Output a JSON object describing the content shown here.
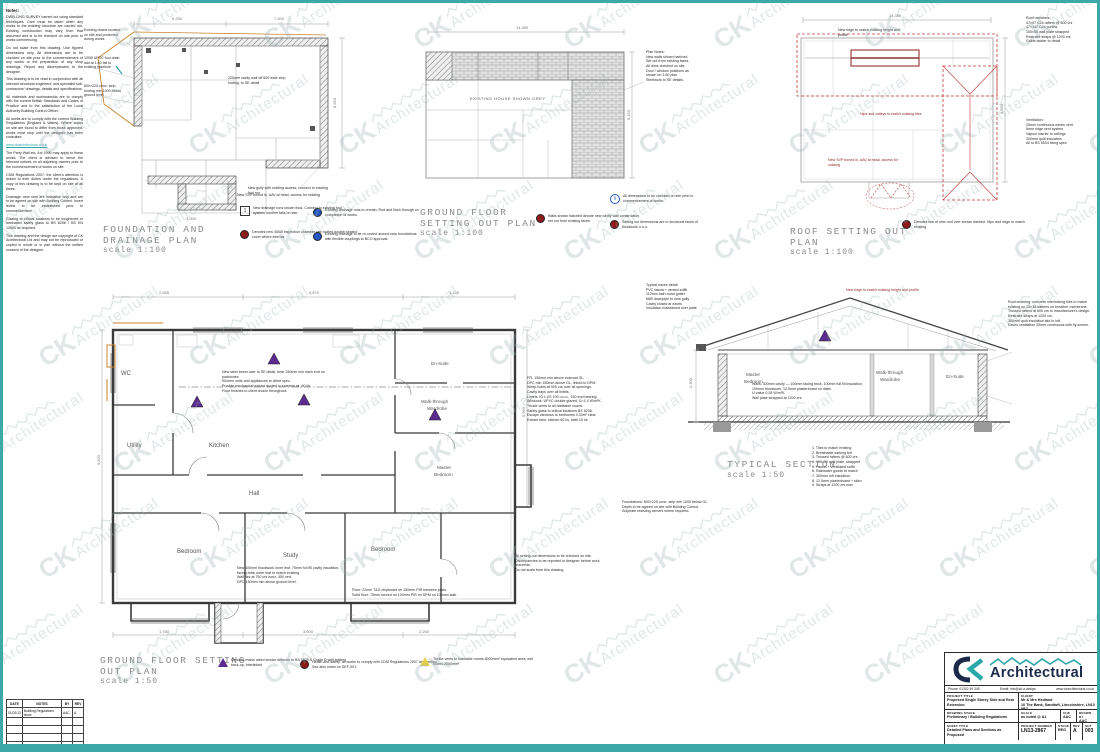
{
  "sheet": {
    "border_color": "#3DA8A8",
    "watermark": {
      "ck": "CK",
      "word": "Architectural"
    }
  },
  "notes_left": {
    "heading": "Notes:",
    "p1": "DWELLING SURVEY carried out using standard techniques. Care must be taken when any works to the existing structure are carried out. Existing construction may vary from that assumed and is to be checked on site prior to works commencing.",
    "p2": "Do not scale from this drawing. Use figured dimensions only. All dimensions are to be checked on site prior to the commencement of any works or the preparation of any shop drawings. Report any discrepancies to the designer.",
    "p3": "This drawing is to be read in conjunction with all relevant structural engineers' and specialist sub-contractors' drawings, details and specifications.",
    "p4": "All materials and workmanship are to comply with the current British Standards and Codes of Practice and to the satisfaction of the Local Authority Building Control Officer.",
    "p5": "All works are to comply with the current Building Regulations (England & Wales). Where works on site are found to differ from those approved, works must stop until the designer has been consulted.",
    "p6": "The Party Wall etc. Act 1996 may apply to these works. The client is advised to serve the relevant notices on all adjoining owners prior to the commencement of works on site.",
    "p7": "CDM Regulations 2007: the client's attention is drawn to their duties under the regulations. A copy of this drawing is to be kept on site at all times.",
    "p8": "Drainage: new runs are indicative only and are to be agreed on site with Building Control. Invert levels to be established prior to commencement.",
    "p9": "Glazing to critical locations to be toughened or laminated safety glass to BS 6206 / BS EN 12600 as required.",
    "p10": "This drawing and the design are copyright of CK Architectural Ltd and may not be reproduced or copied in whole or in part without the written consent of the designer.",
    "link": "www.ckarchitectural.co.uk"
  },
  "revision_table": {
    "headers": [
      "DATE",
      "NOTES",
      "BY",
      "REV"
    ],
    "rows": [
      [
        "01/02/13",
        "Building Regulations issue",
        "AAC",
        "A"
      ]
    ]
  },
  "plans": {
    "foundation": {
      "title": "FOUNDATION AND\nDRAINAGE PLAN",
      "scale": "scale 1:100",
      "dims": {
        "top1": "6,250",
        "top2": "7,400",
        "right": "8,550",
        "porch": "3,000"
      }
    },
    "gf100": {
      "title": "GROUND FLOOR\nSETTING OUT PLAN",
      "scale": "scale 1:100",
      "center_label": "EXISTING HOUSE SHOWN GREY",
      "dims": {
        "top": "14,350",
        "right": "9,150"
      },
      "notes": "Plan Notes:\nNew walls shown hatched.\nSet out from existing faces.\nAll dims checked on site.\nDoor / window positions as\nshown on 1:50 plan.\nSteelwork to SE details."
    },
    "roof": {
      "title": "ROOF SETTING OUT\nPLAN",
      "scale": "scale 1:100",
      "dims": {
        "top": "14,350",
        "right": "9,560"
      },
      "notes1": "Roof members:\n47×97 C24 rafters @ 600 crs\n47×147 C24 purlins\n100×50 wall plate strapped\nRestraint straps @ 1200 crs\nGable ladder to detail",
      "notes2": "Ventilation:\n25mm continuous eaves vent\n5mm ridge vent system\nVapour barrier to ceilings\n300mm quilt insulation\nAll to BS 5534 fixing spec"
    },
    "gf50": {
      "title": "GROUND FLOOR SETTING\nOUT PLAN",
      "scale": "scale 1:50",
      "dims": {
        "top1": "2,655",
        "top2": "4,870",
        "top3": "3,120",
        "left": "9,820",
        "right": "5,960",
        "bottom1": "1,780",
        "bottom2": "3,600",
        "bottom3": "2,250"
      },
      "rooms": {
        "wc": "WC",
        "utility": "Utility",
        "kitchen": "Kitchen",
        "ensuite": "En-Suite",
        "wardrobe1": "Walk-through",
        "wardrobe2": "Wardrobe",
        "master1": "Master",
        "master2": "Bedroom",
        "hall": "Hall",
        "bedroom1": "Bedroom",
        "study": "Study",
        "bedroom2": "Bedroom"
      }
    },
    "section": {
      "title": "TYPICAL SECTION",
      "scale": "scale 1:50",
      "dims": {
        "left": "2,400"
      },
      "rooms": {
        "master1": "Master",
        "master2": "Bedroom",
        "wardrobe1": "Walk-through",
        "wardrobe2": "Wardrobe",
        "ensuite": "En-Suite"
      },
      "notes": "1.  Tiles to match existing\n2.  Breathable sarking felt\n3.  Trussed rafters @ 600 crs\n4.  100×50 wall plate, strapped\n5.  Fascia + ventilated soffit\n6.  Rainwater goods to match\n7.  300mm loft insulation\n8.  12.5mm plasterboard + skim\n9.  Straps at 1200 crs max"
    }
  },
  "legends": {
    "box1": "New drainage runs shown thus. Connect to existing foul system; confirm falls on site.",
    "red_foundation": "Denotes new 450Ø inspection chamber with bolted double-sealed cover where internal.",
    "blue1": "Existing drainage runs to remain. Rod and flush through on completion of works.",
    "blue2": "Existing drainage to be re-routed around new foundations with flexible couplings to BCO approval.",
    "red_gf100": "Walls shown hatched denote new cavity wall construction set out from existing faces.",
    "info": "All dimensions to be checked on site prior to commencement of works.",
    "red_gf100b": "Setting out dimensions are to structural faces of blockwork u.n.o.",
    "red_roof": "Denotes line of new roof over shown dashed. Hips and ridge to match existing.",
    "purple": "Denotes mains wired smoke detector to BS 5839-6 Grade D with battery back-up, interlinked.",
    "red_gf50": "Health and safety: all works to comply with CDM Regulations 2007 as directed. See also notes on DEF-001.",
    "yellow": "Trickle vents to habitable rooms 8000mm² equivalent area; wet rooms 2500mm²."
  },
  "micro": {
    "a": "100Ø UPVC foul drain laid at 1:40 fall to existing manhole",
    "b": "600×225 conc. strip footing min 1000 below ground level",
    "c": "Existing drains located on site and protected during works",
    "d": "225mm cavity wall off 600 wide strip footing, to SE detail",
    "e": "New SVP boxed in, AAV at head, access for rodding",
    "f": "New gully with rodding access; connect to existing foul run",
    "g": "New ridge to match existing height and profile",
    "h": "Hips and valleys to match existing tiles"
  },
  "ann": {
    "gf50_right": "FFL 150mm min above external GL.\nDPC min 150mm above GL, linked to DPM.\nWeep holes at 900 crs over all openings.\nCavity trays over all lintels.\nLintels: IG L1/S 100 u.n.o., 150 end bearing.\nWindows: UPVC double glazed, U=1.4 W/m²K.\nTrickle vents to all habitable rooms.\nSafety glass to critical locations BS 6206.\nEscape windows to bedrooms 0.33m² clear.\nExtract fans: kitchen 60 l/s, bath 15 l/s.",
    "gf50_bottom1": "New 100mm blockwork inner leaf, 75mm full fill cavity insulation, facing brick outer leaf to match existing.\nWall ties at 750 crs horiz, 450 vert.\nDPC 150mm min above ground level.",
    "gf50_bottom2": "Floor: 22mm T&G chipboard on 150mm PIR between joists.\nSolid floor: 75mm screed on 100mm PIR on DPM on 100mm slab.",
    "gf50_bottom3": "All setting out dimensions to be checked on site.\nDiscrepancies to be reported to designer before work proceeds.\nDo not scale from this drawing.",
    "gf50_center": "New steel beam over to SE detail, bear 150mm min each end on padstones.\nKitchen units and appliances to client spec.\nProvide mechanical extract ducted to external air, 60 l/s.\nFloor finishes to client choice throughout.",
    "section_center": "Walls: 300mm cavity — 100mm facing brick, 100mm full fill insulation, 100mm blockwork, 12.5mm plasterboard on dabs.\nU-value 0.28 W/m²K.\nWall plate strapped at 1200 crs.",
    "section_right": "Roof covering: concrete interlocking tiles to match existing on 25×38 battens on breather membrane.\nTrussed rafters at 600 crs to manufacturer's design.\nRestraint straps at 1200 crs.\n300mm quilt insulation laid in loft.\nEaves ventilation 25mm continuous with fly screen.",
    "section_below": "Foundations: 600×225 conc. strip min 1000 below GL.\nDepth to be agreed on site with Building Control.\nSulphate resisting cement where required.",
    "buildup": "Typical eaves detail:\nPVC fascia + vented soffit\n112mm half round gutter\n68Ø downpipe to new gully\nCavity closed at eaves\nInsulation maintained over plate"
  },
  "title_block": {
    "contact": {
      "phone": "Phone: 01302 49 345",
      "email": "Email: info@ck-a.design",
      "web": "www.ckarchitectural.co.uk"
    },
    "labels": {
      "project_title": "PROJECT TITLE",
      "client": "CLIENT",
      "drawing_stage": "DRAWING STAGE",
      "scale": "SCALE",
      "chk": "CHK",
      "drawn_by": "DRAWN BY",
      "sheet_title": "SHEET TITLE",
      "project_number": "PROJECT NUMBER",
      "stage": "STAGE",
      "rev": "REV",
      "sht": "SHT"
    },
    "values": {
      "project_title": "Proposed Single Storey Side and Rear Extension",
      "client": "Mr & Mrs Hedland\n10 The Bank, Sandtoft, Lincolnshire, LN13 0BZ",
      "drawing_stage": "Preliminary / Building Regulations",
      "scale": "as noted @ A1",
      "chk": "AAC",
      "drawn_by": "AAC",
      "sheet_title": "Detailed Plans and Sections as Proposed",
      "project_number": "LN13-2867",
      "stage": "REG",
      "rev": "A",
      "sht": "003"
    },
    "logo": {
      "ck": "CK",
      "word": "Architectural"
    }
  }
}
